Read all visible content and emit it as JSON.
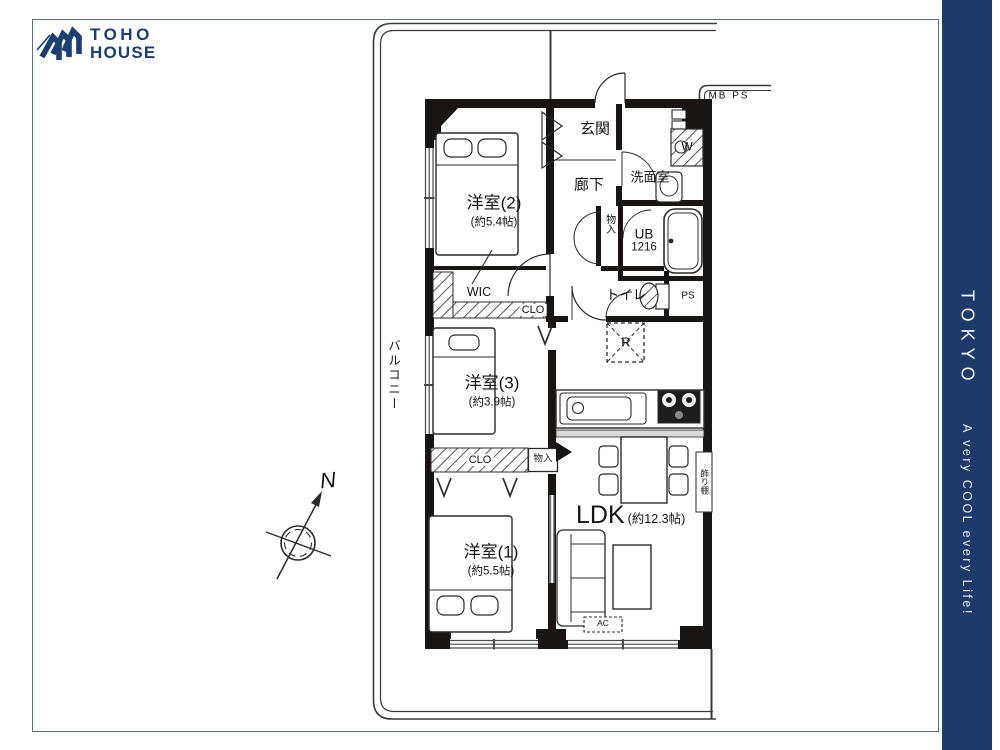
{
  "brand": {
    "logo_line1": "TOHO",
    "logo_line2": "HOUSE"
  },
  "side_banner": {
    "city": "TOKYO",
    "tagline": "A very COOL every Life!"
  },
  "compass": {
    "north": "N"
  },
  "plan": {
    "balcony": "バルコニー",
    "entrance": "玄関",
    "corridor": "廊下",
    "washroom": "洗面室",
    "hall_storage": "物入",
    "bath_name": "UB",
    "bath_size": "1216",
    "toilet": "トイレ",
    "pipe_space": "PS",
    "meter_pipe": "MB PS",
    "walk_in_closet": "WIC",
    "closet_upper": "CLO",
    "closet_lower": "CLO",
    "mid_storage": "物入",
    "shelf": "飾り棚",
    "fridge_mark": "R",
    "washer_mark": "W",
    "ac_mark": "AC",
    "bedroom2": {
      "name": "洋室(2)",
      "size": "(約5.4帖)"
    },
    "bedroom3": {
      "name": "洋室(3)",
      "size": "(約3.9帖)"
    },
    "bedroom1": {
      "name": "洋室(1)",
      "size": "(約5.5帖)"
    },
    "ldk": {
      "name": "LDK",
      "size": "(約12.3帖)"
    }
  },
  "colors": {
    "navy": "#1d3a6b",
    "logo_navy": "#1c3e70",
    "line": "#2b2b2b",
    "wall": "#1a1512",
    "frame": "#5b7484"
  }
}
